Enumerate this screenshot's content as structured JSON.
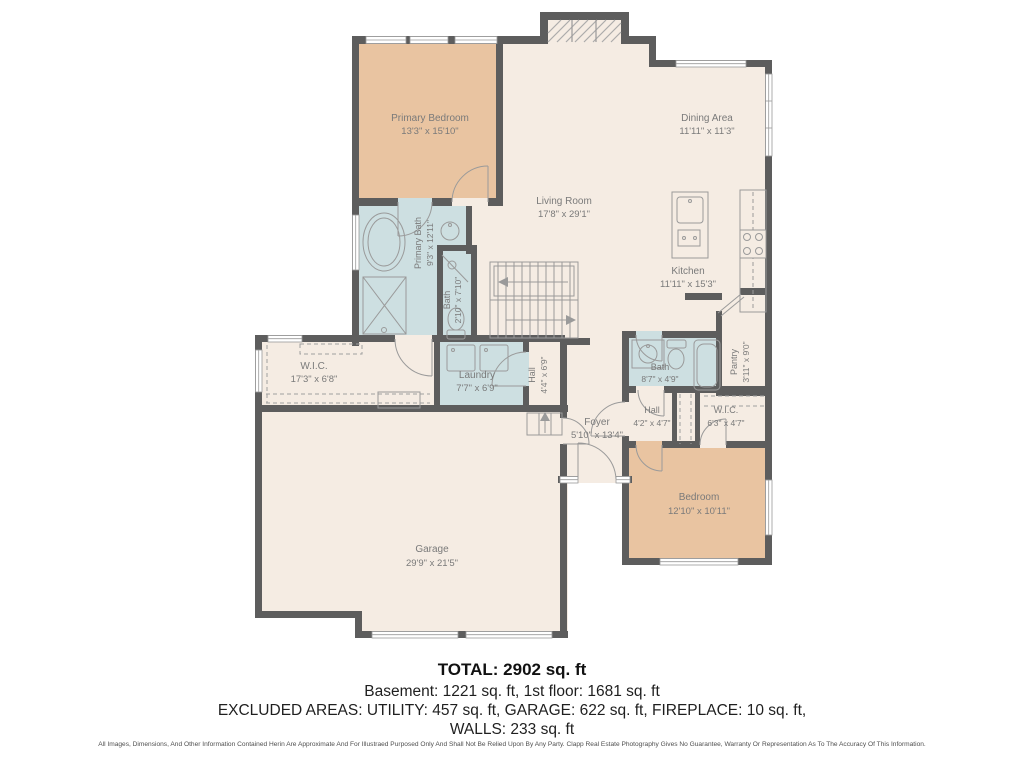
{
  "colors": {
    "wall": "#5d5d5d",
    "floor": "#f5ece3",
    "bedroom_fill": "#e9c4a1",
    "bath_fill": "#cddfe1",
    "label_text": "#7a7a7a",
    "fixture_stroke": "#9a9a9a"
  },
  "rooms": {
    "primary_bedroom": {
      "name": "Primary Bedroom",
      "dims": "13'3\" x 15'10\""
    },
    "dining": {
      "name": "Dining Area",
      "dims": "11'11\" x 11'3\""
    },
    "living": {
      "name": "Living Room",
      "dims": "17'8\" x 29'1\""
    },
    "kitchen": {
      "name": "Kitchen",
      "dims": "11'11\" x 15'3\""
    },
    "primary_bath": {
      "name": "Primary Bath",
      "dims": "9'3\" x 12'11\""
    },
    "bath_small": {
      "name": "Bath",
      "dims": "2'10\" x 7'10\""
    },
    "wic_left": {
      "name": "W.I.C.",
      "dims": "17'3\" x 6'8\""
    },
    "laundry": {
      "name": "Laundry",
      "dims": "7'7\" x 6'9\""
    },
    "hall_left": {
      "name": "Hall",
      "dims": "4'4\" x 6'9\""
    },
    "bath_right": {
      "name": "Bath",
      "dims": "8'7\" x 4'9\""
    },
    "pantry": {
      "name": "Pantry",
      "dims": "3'11\" x 9'0\""
    },
    "foyer": {
      "name": "Foyer",
      "dims": "5'10\" x 13'4\""
    },
    "hall_right": {
      "name": "Hall",
      "dims": "4'2\" x 4'7\""
    },
    "wic_right": {
      "name": "W.I.C.",
      "dims": "6'3\" x 4'7\""
    },
    "bedroom": {
      "name": "Bedroom",
      "dims": "12'10\" x 10'11\""
    },
    "garage": {
      "name": "Garage",
      "dims": "29'9\" x 21'5\""
    }
  },
  "summary": {
    "total": "TOTAL: 2902 sq. ft",
    "line2": "Basement: 1221 sq. ft, 1st floor: 1681 sq. ft",
    "line3": "EXCLUDED AREAS: UTILITY: 457 sq. ft, GARAGE: 622 sq. ft, FIREPLACE: 10 sq. ft,",
    "line4": "WALLS: 233 sq. ft"
  },
  "disclaimer": "All Images, Dimensions, And Other Information Contained Herin Are Approximate And For Illustraed Purposed Only And Shall Not Be Relied Upon By Any Party. Clapp Real Estate Photography Gives No Guarantee, Warranty Or Representation As To The Accuracy Of This Information."
}
